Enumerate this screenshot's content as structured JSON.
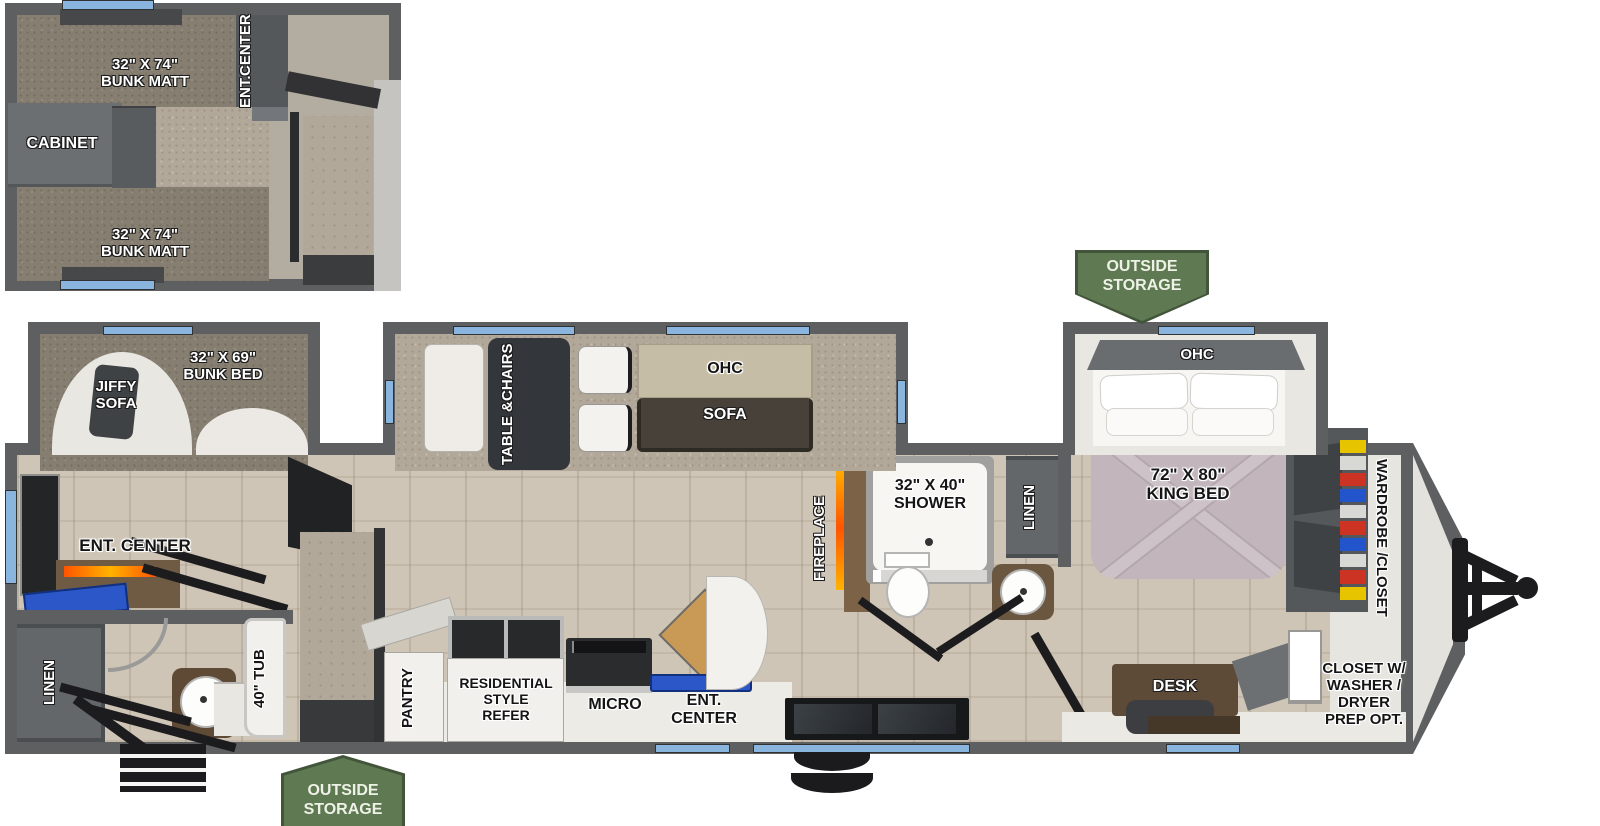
{
  "colors": {
    "wall_gray": "#5d5f61",
    "window_blue": "#8ab5de",
    "badge_green": "#5f7a52",
    "fireplace_orange": "#ff6a00",
    "bed_blanket": "#c2b6bc",
    "ohc_tan": "#c6bda6"
  },
  "labels": {
    "loft_bunk_top": [
      "32\" X 74\"",
      "BUNK MATT"
    ],
    "loft_bunk_bottom": [
      "32\" X 74\"",
      "BUNK MATT"
    ],
    "loft_ent_center": [
      "ENT.",
      "CENTER"
    ],
    "loft_cabinet": "CABINET",
    "jiffy_sofa": [
      "JIFFY",
      "SOFA"
    ],
    "bunk_bed": [
      "32\" X 69\"",
      "BUNK BED"
    ],
    "table_chairs": [
      "TABLE &",
      "CHAIRS"
    ],
    "ohc_living": "OHC",
    "sofa": "SOFA",
    "fireplace": "FIREPLACE",
    "shower": [
      "32\" X 40\"",
      "SHOWER"
    ],
    "linen_bath": "LINEN",
    "ohc_bedroom": "OHC",
    "king_bed": [
      "72\" X 80\"",
      "KING BED"
    ],
    "wardrobe_closet": [
      "WARDROBE /",
      "CLOSET"
    ],
    "closet_washer": [
      "CLOSET W/",
      "WASHER /",
      "DRYER",
      "PREP OPT."
    ],
    "desk": "DESK",
    "outside_storage_front": [
      "OUTSIDE",
      "STORAGE"
    ],
    "outside_storage_rear": [
      "OUTSIDE",
      "STORAGE"
    ],
    "pantry": "PANTRY",
    "refer": [
      "RESIDENTIAL",
      "STYLE",
      "REFER"
    ],
    "micro": "MICRO",
    "ent_center_kitchen": [
      "ENT.",
      "CENTER"
    ],
    "ent_center_rear": "ENT. CENTER",
    "linen_rear": "LINEN",
    "tub": "40\" TUB"
  }
}
